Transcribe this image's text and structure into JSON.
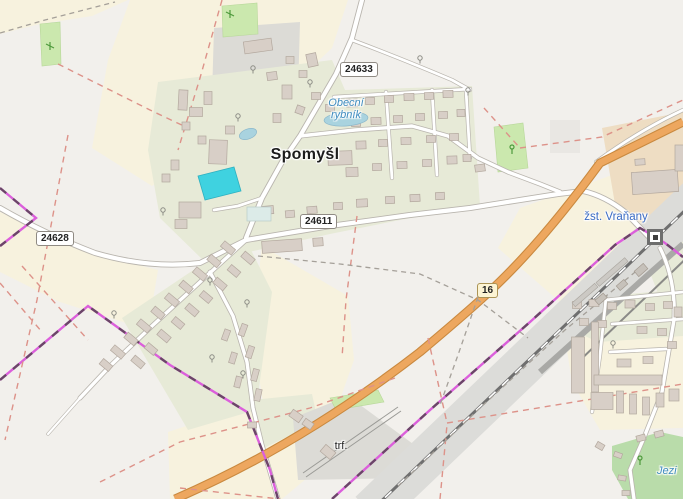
{
  "labels": {
    "place": "Spomyšl",
    "water_line1": "Obecní",
    "water_line2": "rybník",
    "station": "žst. Vraňany",
    "transformer": "trf.",
    "water2": "Jezi"
  },
  "road_refs": {
    "north": "24633",
    "west": "24628",
    "central": "24611",
    "highway": "16"
  },
  "colors": {
    "background": "#f2f0ec",
    "farmland": "#f7f2de",
    "farmland_brown": "#eeddc3",
    "residential": "#e7ead7",
    "grass": "#cbe8ae",
    "wood": "#b9dcaa",
    "building": "#d8cfc7",
    "road_casing": "#b9b5ae",
    "primary_road": "#eda75f",
    "railway_band": "#dcdcd9",
    "rail_track": "#6f6f6f",
    "boundary": "#db5fdb",
    "track_red": "#dd9289",
    "water": "#a9d3df",
    "pool": "#3fd2e0",
    "place_label_color": "#1c1c1c",
    "water_label_color": "#3f8cbf",
    "station_label_color": "#3a6bc4"
  }
}
